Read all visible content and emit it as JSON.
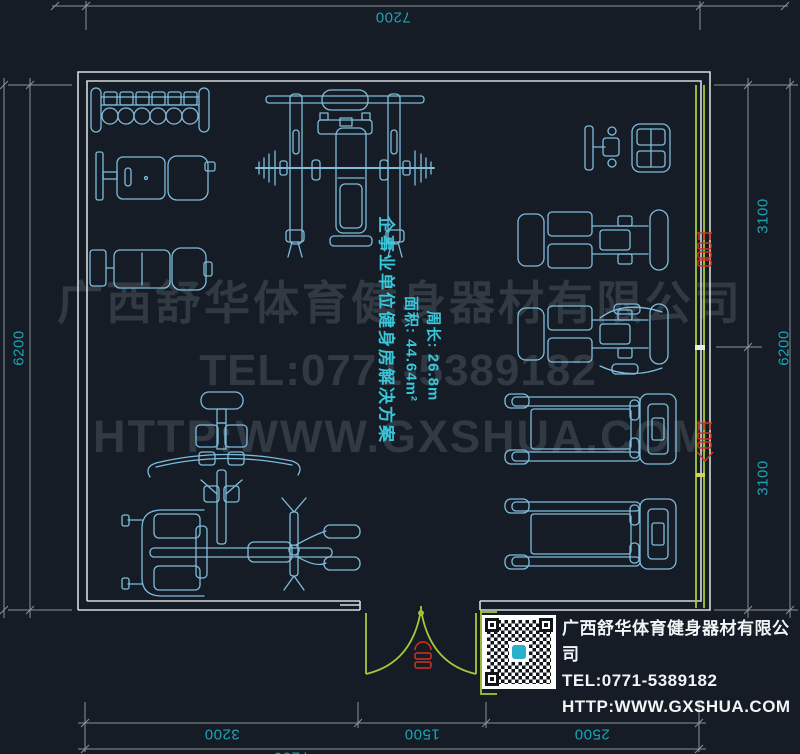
{
  "dimensions": {
    "top": "7200",
    "bottom": [
      "3200",
      "1500",
      "2500"
    ],
    "bottom_total": "7200",
    "left": "6200",
    "left_total": "6200",
    "right": [
      "3100",
      "3100"
    ],
    "right_total": "6200"
  },
  "annotation": {
    "title": "企事业单位健身房解决方案",
    "area": "面积: 44.64m²",
    "perimeter": "周长: 26.8m"
  },
  "watermark": {
    "line1": "广西舒华体育健身器材有限公司",
    "line2": "TEL:0771-5389182",
    "line3": "HTTP:WWW.GXSHUA.COM"
  },
  "legend": {
    "company": "广西舒华体育健身器材有限公司",
    "tel": "TEL:0771-5389182",
    "url": "HTTP:WWW.GXSHUA.COM"
  },
  "equipment": [
    "dumbbell-rack",
    "adjustable-bench",
    "flat-bench",
    "bench-press-station",
    "exercise-bike",
    "seated-strength-machine-1",
    "seated-strength-machine-2",
    "multi-station-machine",
    "treadmill-1",
    "treadmill-2"
  ],
  "colors": {
    "background": "#151c25",
    "wall": "#d5dadd",
    "window_door_green": "#a5c93a",
    "dimension_line": "#8b9399",
    "dimension_text": "#1da4b6",
    "equipment_line": "#7fbcdc",
    "annotation_text": "#38c6d9",
    "tag_red": "#d2331f",
    "legend_text": "#f2f4f6"
  }
}
